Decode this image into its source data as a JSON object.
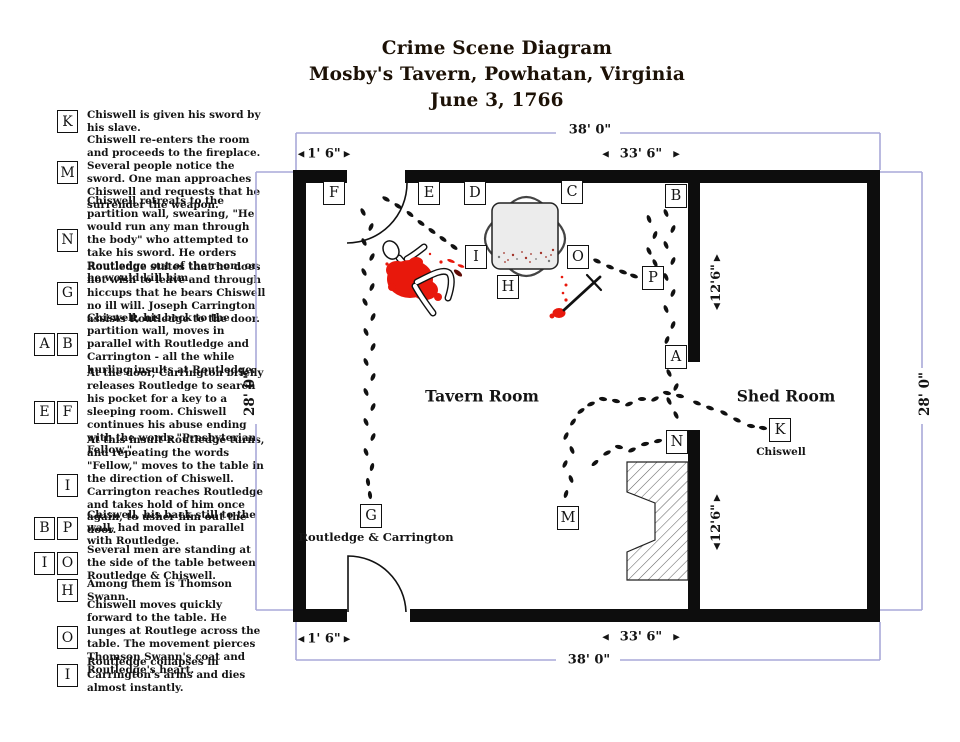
{
  "title": {
    "line1": "Crime Scene Diagram",
    "line2": "Mosby's Tavern, Powhatan, Virginia",
    "line3": "June 3, 1766"
  },
  "glyphs": {
    "left": "◀",
    "right": "▶",
    "up": "▲",
    "down": "▼"
  },
  "legend": [
    {
      "letters": [
        "K"
      ],
      "text": "Chiswell is given his sword by his slave."
    },
    {
      "letters": [
        "M"
      ],
      "text": "Chiswell re-enters the room and proceeds to the fireplace. Several people notice the sword. One man approaches Chiswell and requests that he surrender the weapon."
    },
    {
      "letters": [
        "N"
      ],
      "text": "Chiswell retreats to the partition wall, swearing, \"He would run any man through the body\" who attempted to take his sword. He orders Routledge out of the room or he would kill him."
    },
    {
      "letters": [
        "G"
      ],
      "text": "Routledge states that he does not wish to leave and through hiccups that he bears Chiswell no ill will. Joseph Carrington assists Routledge to the door."
    },
    {
      "letters": [
        "A",
        "B"
      ],
      "text": "Chiswell, his back to the partition wall, moves in parallel with Routledge and Carrington - all the while hurling insults at Routledge."
    },
    {
      "letters": [
        "E",
        "F"
      ],
      "text": "At the door, Carrington briefly releases Routledge to search his pocket for a key to a sleeping room. Chiswell continues his abuse ending with the words \"Presbyterian Fellow.\""
    },
    {
      "letters": [
        "I"
      ],
      "text": "At this insult Routledge turns, and repeating the words \"Fellow,\" moves to the table in the direction of Chiswell. Carrington reaches Routledge and takes hold of him once again, to usher him out the door."
    },
    {
      "letters": [
        "B",
        "P"
      ],
      "text": "Chiswell, his back still to the wall, had moved in parallel with Routledge."
    },
    {
      "letters": [
        "I",
        "O"
      ],
      "text": "Several men are standing at the side of the table between Routledge & Chiswell."
    },
    {
      "letters": [
        "H"
      ],
      "text": "Among them is Thomson Swann."
    },
    {
      "letters": [
        "O"
      ],
      "text": "Chiswell moves quickly forward to the table. He lunges at Routlege across the table. The movement pierces Thomson Swann's coat and Routledge's heart."
    },
    {
      "letters": [
        "I"
      ],
      "text": "Routledge collapses in Carrington's arms and dies almost instantly."
    }
  ],
  "diagram": {
    "rooms": [
      {
        "label": "Tavern Room",
        "x": 482,
        "y": 396
      },
      {
        "label": "Shed Room",
        "x": 786,
        "y": 396
      }
    ],
    "captions": [
      {
        "text": "Routledge & Carrington",
        "x": 376,
        "y": 537
      },
      {
        "text": "Chiswell",
        "x": 781,
        "y": 452
      }
    ],
    "markers": [
      {
        "letter": "F",
        "x": 334,
        "y": 193
      },
      {
        "letter": "E",
        "x": 429,
        "y": 193
      },
      {
        "letter": "D",
        "x": 475,
        "y": 193
      },
      {
        "letter": "C",
        "x": 572,
        "y": 192
      },
      {
        "letter": "B",
        "x": 676,
        "y": 196
      },
      {
        "letter": "I",
        "x": 476,
        "y": 257
      },
      {
        "letter": "H",
        "x": 508,
        "y": 287
      },
      {
        "letter": "O",
        "x": 578,
        "y": 257
      },
      {
        "letter": "P",
        "x": 653,
        "y": 278
      },
      {
        "letter": "A",
        "x": 676,
        "y": 357
      },
      {
        "letter": "N",
        "x": 677,
        "y": 442
      },
      {
        "letter": "K",
        "x": 780,
        "y": 430
      },
      {
        "letter": "G",
        "x": 371,
        "y": 516
      },
      {
        "letter": "M",
        "x": 568,
        "y": 518
      }
    ],
    "dimensions": {
      "top_width": "38' 0\"",
      "bottom_width": "38' 0\"",
      "left_height": "28' 0\"",
      "right_height": "28' 0\"",
      "top_left_offset": "1' 6\"",
      "top_main": "33' 6\"",
      "bottom_left_offset": "1' 6\"",
      "bottom_main": "33' 6\"",
      "shed_upper": "12'6\"",
      "shed_lower": "12'6\""
    },
    "colors": {
      "blood": "#e8180c",
      "bracket": "#a9a9d9",
      "wall": "#0d0d0d"
    },
    "trails": [
      [
        [
          363,
          212
        ],
        [
          371,
          227
        ],
        [
          364,
          242
        ],
        [
          372,
          257
        ],
        [
          364,
          272
        ],
        [
          372,
          287
        ],
        [
          365,
          302
        ],
        [
          373,
          317
        ],
        [
          366,
          332
        ],
        [
          373,
          347
        ],
        [
          366,
          362
        ],
        [
          373,
          377
        ],
        [
          366,
          392
        ],
        [
          373,
          407
        ],
        [
          366,
          422
        ],
        [
          373,
          437
        ],
        [
          366,
          452
        ],
        [
          372,
          467
        ],
        [
          368,
          482
        ],
        [
          370,
          495
        ]
      ],
      [
        [
          386,
          199
        ],
        [
          398,
          206
        ],
        [
          410,
          214
        ],
        [
          421,
          223
        ],
        [
          432,
          231
        ],
        [
          443,
          239
        ],
        [
          454,
          247
        ]
      ],
      [
        [
          666,
          213
        ],
        [
          673,
          229
        ],
        [
          666,
          245
        ],
        [
          673,
          261
        ],
        [
          666,
          277
        ],
        [
          673,
          293
        ],
        [
          666,
          309
        ],
        [
          673,
          325
        ],
        [
          667,
          340
        ]
      ],
      [
        [
          649,
          219
        ],
        [
          655,
          235
        ],
        [
          649,
          251
        ],
        [
          655,
          263
        ]
      ],
      [
        [
          669,
          373
        ],
        [
          676,
          387
        ],
        [
          669,
          401
        ],
        [
          676,
          415
        ]
      ],
      [
        [
          597,
          261
        ],
        [
          610,
          267
        ],
        [
          623,
          272
        ],
        [
          634,
          276
        ]
      ],
      [
        [
          697,
          403
        ],
        [
          710,
          408
        ],
        [
          724,
          413
        ],
        [
          737,
          420
        ],
        [
          751,
          426
        ],
        [
          763,
          428
        ]
      ],
      [
        [
          566,
          494
        ],
        [
          571,
          479
        ],
        [
          565,
          464
        ],
        [
          572,
          450
        ],
        [
          566,
          436
        ],
        [
          573,
          422
        ],
        [
          581,
          411
        ],
        [
          591,
          404
        ],
        [
          603,
          399
        ],
        [
          616,
          401
        ],
        [
          629,
          404
        ],
        [
          642,
          399
        ],
        [
          655,
          399
        ],
        [
          667,
          393
        ],
        [
          680,
          396
        ]
      ],
      [
        [
          595,
          463
        ],
        [
          607,
          453
        ],
        [
          619,
          447
        ],
        [
          632,
          450
        ],
        [
          645,
          444
        ],
        [
          658,
          441
        ]
      ]
    ]
  }
}
